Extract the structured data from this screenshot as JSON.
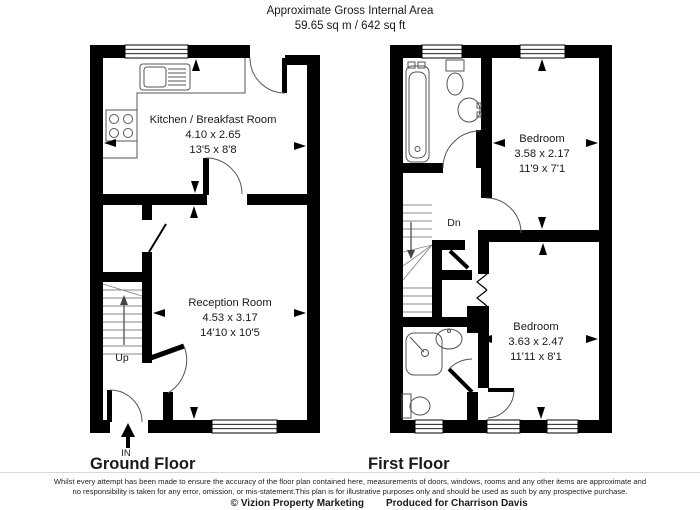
{
  "header": {
    "title": "Approximate Gross Internal Area",
    "area": "59.65 sq m / 642 sq ft"
  },
  "ground_floor": {
    "label": "Ground Floor",
    "entrance_label": "IN",
    "stairs_label": "Up",
    "rooms": [
      {
        "name": "Kitchen / Breakfast Room",
        "metric": "4.10 x 2.65",
        "imperial": "13'5 x 8'8"
      },
      {
        "name": "Reception Room",
        "metric": "4.53 x 3.17",
        "imperial": "14'10 x 10'5"
      }
    ]
  },
  "first_floor": {
    "label": "First Floor",
    "stairs_label": "Dn",
    "rooms": [
      {
        "name": "Bedroom",
        "metric": "3.58 x 2.17",
        "imperial": "11'9 x 7'1"
      },
      {
        "name": "Bedroom",
        "metric": "3.63 x 2.47",
        "imperial": "11'11 x 8'1"
      }
    ]
  },
  "footer": {
    "disclaimer_line1": "Whilst every attempt has been made to ensure the accuracy of the floor plan contained here, measurements of doors, windows, rooms and any other items are approximate and",
    "disclaimer_line2": "no responsibility is taken for any error, omission, or mis-statement.This plan is for illustrative purposes only and should be used as such by any prospective purchase.",
    "copyright": "© Vizion Property Marketing",
    "produced_for": "Produced for Charrison Davis"
  },
  "colors": {
    "wall": "#000000",
    "fixture_line": "#555555",
    "text": "#1a1a1a",
    "background": "#ffffff"
  }
}
